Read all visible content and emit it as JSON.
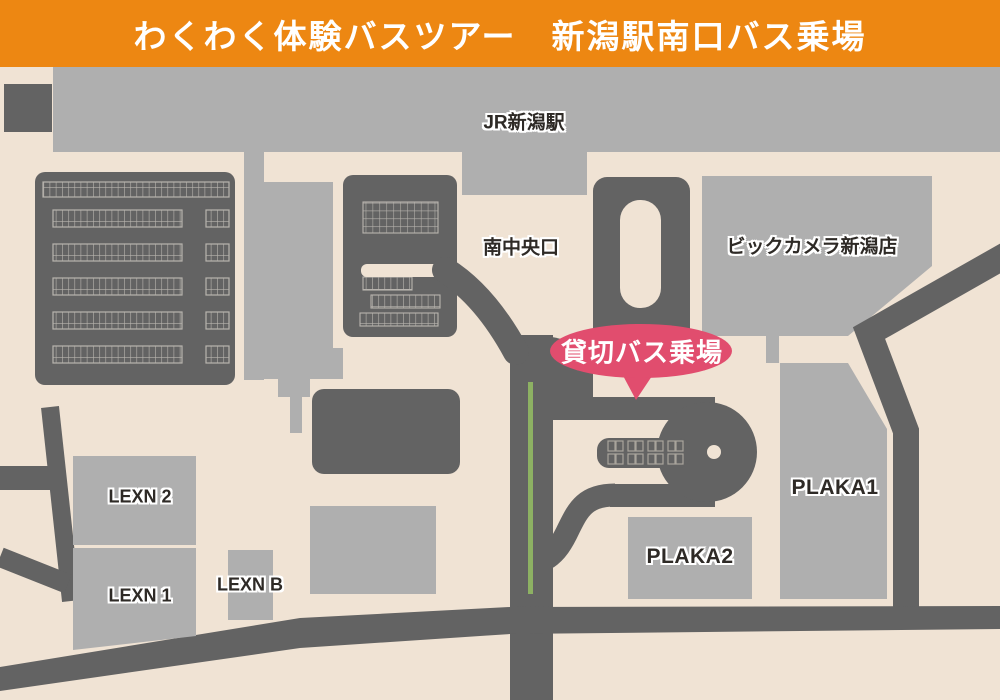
{
  "header": {
    "title": "わくわく体験バスツアー　新潟駅南口バス乗場",
    "bg_color": "#ED8712",
    "text_color": "#FFFFFF"
  },
  "map": {
    "background_color": "#F0E3D4",
    "road_and_dark_building_color": "#636363",
    "light_building_color": "#AFAFAF",
    "parking_grid_line_color": "#B8B4AE",
    "green_guide_line_color": "#8DB163",
    "label_text_color": "#2E2A26",
    "labels": {
      "jr_station": "JR新潟駅",
      "south_central_exit": "南中央口",
      "bic_camera": "ビックカメラ新潟店",
      "plaka1": "PLAKA1",
      "plaka2": "PLAKA2",
      "lexn2": "LEXN 2",
      "lexn1": "LEXN 1",
      "lexnb": "LEXN B"
    },
    "callout": {
      "text": "貸切バス乗場",
      "bg_color": "#E14D6E",
      "text_color": "#FFFFFF"
    }
  }
}
